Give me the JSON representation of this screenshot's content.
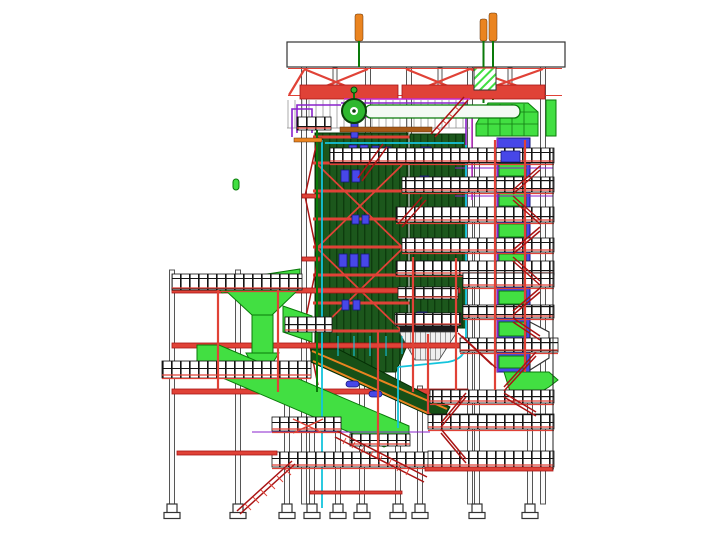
{
  "meta": {
    "description": "CAD side-elevation drawing of a power-plant boiler island structure",
    "drawing_type": "3D model elevation view",
    "background": "#ffffff"
  },
  "palette": {
    "red": "#e04237",
    "dark_red": "#a91414",
    "bright_green": "#42df42",
    "green_outline": "#0a7a0a",
    "green_line": "#127a12",
    "furnace_green": "#1c571c",
    "furnace_stripe": "#0e3c0e",
    "chute_green": "#175017",
    "blue": "#4747e8",
    "blue_dark": "#17177a",
    "purple": "#8a22cc",
    "magenta": "#c228cc",
    "cyan": "#14c4dc",
    "orange": "#ea8420",
    "brown": "#a85a18",
    "column_fill": "#fafafa",
    "column_stroke": "#555555",
    "white": "#ffffff"
  },
  "components": {
    "roof_girder": "Roof girder",
    "silencer_stacks": "Safety valve silencer stacks",
    "roof_truss": "Roof truss bracing",
    "steam_drum": "Steam drum",
    "header_pipe": "Steam header pipe",
    "penthouse": "Penthouse hanger rods",
    "furnace": "Furnace waterwall",
    "burner_ports": "Burner and access ports",
    "buckstays": "Buckstay bands",
    "backpass": "Convective backpass",
    "backpass_hopper": "Backpass hopper",
    "flue_duct": "Flue gas duct",
    "air_duct": "Air duct",
    "stair_tower": "Stair tower",
    "walkways": "Walkway platforms with handrails",
    "columns": "Structural support columns",
    "footings": "Column base footings",
    "feed_hopper": "Feed hopper and downcomer duct",
    "conveyor": "Inclined conveyor duct",
    "ash_chute": "Ash discharge chute",
    "piping": "Process piping runs"
  }
}
